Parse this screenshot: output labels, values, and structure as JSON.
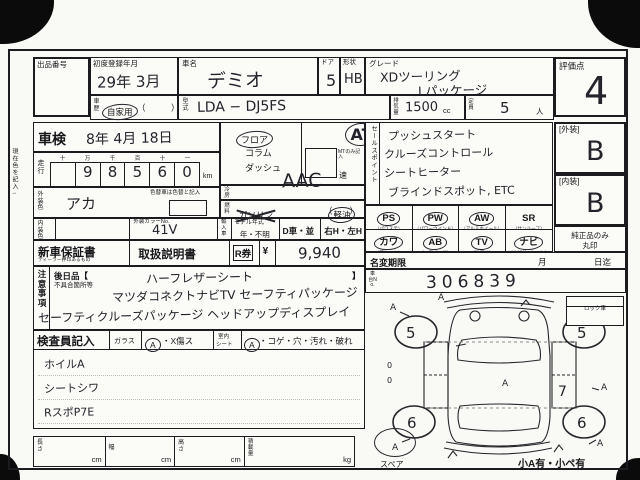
{
  "misc": {
    "margin_note": "現在色を記入→"
  },
  "header": {
    "exhibit_no_label": "出品番号",
    "first_reg_label": "初度登録年月",
    "first_reg_value": "29年 3月",
    "history_label": "車歴",
    "history_value": "自家用",
    "history_paren": "（　　　）",
    "car_name_label": "車名",
    "car_name_value": "デミオ",
    "model_label": "型式",
    "model_value": "LDA − DJ5FS",
    "door_label": "ドア",
    "door_value": "5",
    "shape_label": "形状",
    "shape_value": "HB",
    "grade_label": "グレード",
    "grade_line1": "XDツーリング",
    "grade_line2": "Lパッケージ",
    "disp_label": "排気量",
    "disp_value": "1500",
    "disp_unit": "cc",
    "cap_label": "定員",
    "cap_value": "5",
    "cap_unit": "人",
    "score_label": "評価点",
    "score_value": "4"
  },
  "mileage": {
    "shaken_label": "車検",
    "shaken_value": "8年 4月 18日",
    "label": "走行",
    "digit_headers": [
      "十",
      "万",
      "千",
      "百",
      "十",
      "一"
    ],
    "digits": [
      "",
      "9",
      "8",
      "5",
      "6",
      "0"
    ],
    "unit": "km"
  },
  "colors": {
    "ext_label": "外装色",
    "ext_value": "アカ",
    "change_note": "色替車は色替と記入",
    "int_label": "内装色",
    "color_no_label": "外装カラーNo.",
    "color_no_value": "41V"
  },
  "shift": {
    "floor": "フロア",
    "column": "コラム",
    "dash": "ダッシュ",
    "at": "AT",
    "mt_note": "MTのみ記入",
    "speed": "速"
  },
  "aircon": {
    "label": "冷房",
    "value": "AAC"
  },
  "fuel": {
    "label": "燃料",
    "gas": "ガソリン",
    "diesel": "軽油",
    "paren": "（　　）"
  },
  "modelyear": {
    "import_label": "輸入車",
    "label": "モデル年式",
    "year_unknown": "年・不明",
    "d_car": "D車・並",
    "handle": "右H・左H"
  },
  "sales": {
    "label": "セールスポイント",
    "lines": [
      "プッシュスタート",
      "クルーズコントロール",
      "シートヒーター",
      "ブラインドスポット, ETC"
    ]
  },
  "equipment": {
    "items": [
      {
        "code": "PS",
        "sub": "（パワステ）",
        "circled": true
      },
      {
        "code": "PW",
        "sub": "（パワーウインド）",
        "circled": true
      },
      {
        "code": "AW",
        "sub": "（アルミホイール）",
        "circled": true
      },
      {
        "code": "SR",
        "sub": "（サンルーフ）",
        "circled": false
      },
      {
        "code": "カワ",
        "sub": "（革シート）",
        "circled": true
      },
      {
        "code": "AB",
        "sub": "（エアバッグ）",
        "circled": true
      },
      {
        "code": "TV",
        "sub": "（地デジ）",
        "circled": true
      },
      {
        "code": "ナビ",
        "sub": "（ナビゲーション）",
        "circled": true
      }
    ]
  },
  "ratings": {
    "ext_label": "[外装]",
    "ext_value": "B",
    "int_label": "[内装]",
    "int_value": "B",
    "genuine_note_1": "純正品のみ",
    "genuine_note_2": "丸印"
  },
  "docs": {
    "warranty": "新車保証書",
    "warranty_sub": "ディーラー押印あるもの",
    "manual": "取扱説明書",
    "r_label": "R券",
    "yen": "¥",
    "r_value": "9,940"
  },
  "namechange": {
    "label": "名変期限",
    "month": "月",
    "until": "日迄"
  },
  "chassis": {
    "label": "車台No.",
    "value": "306839"
  },
  "notes": {
    "label": "注意事項",
    "later_label": "後日品【",
    "later_close": "】",
    "defect_label": "不具合箇所等",
    "lines": [
      "ハーフレザーシート",
      "マツダコネクトナビTV セーフティパッケージ",
      "セーフティクルーズパッケージ ヘッドアップディスプレイ"
    ]
  },
  "inspector": {
    "label": "検査員記入",
    "glass_label": "ガラス",
    "glass_a": "A",
    "glass_rest": "・X傷ス",
    "seat_label_1": "室内",
    "seat_label_2": "シート",
    "seat_a": "A",
    "seat_rest": "・コゲ・穴・汚れ・破れ",
    "lines": [
      "ホイルA",
      "シートシワ",
      "RスポP7E"
    ]
  },
  "diagram": {
    "lock_label": "ロック車",
    "tire_fl": "5",
    "tire_fr": "5",
    "tire_rl": "6",
    "tire_rr": "6",
    "mark_a": "A",
    "mark_7": "7",
    "mark_0": "0",
    "spare_label": "スペア",
    "corner_note": "小A有・小ペ有"
  },
  "dims": {
    "length_label": "長さ",
    "width_label": "幅",
    "height_label": "高さ",
    "load_label": "積載量",
    "cm": "cm",
    "kg": "kg"
  }
}
